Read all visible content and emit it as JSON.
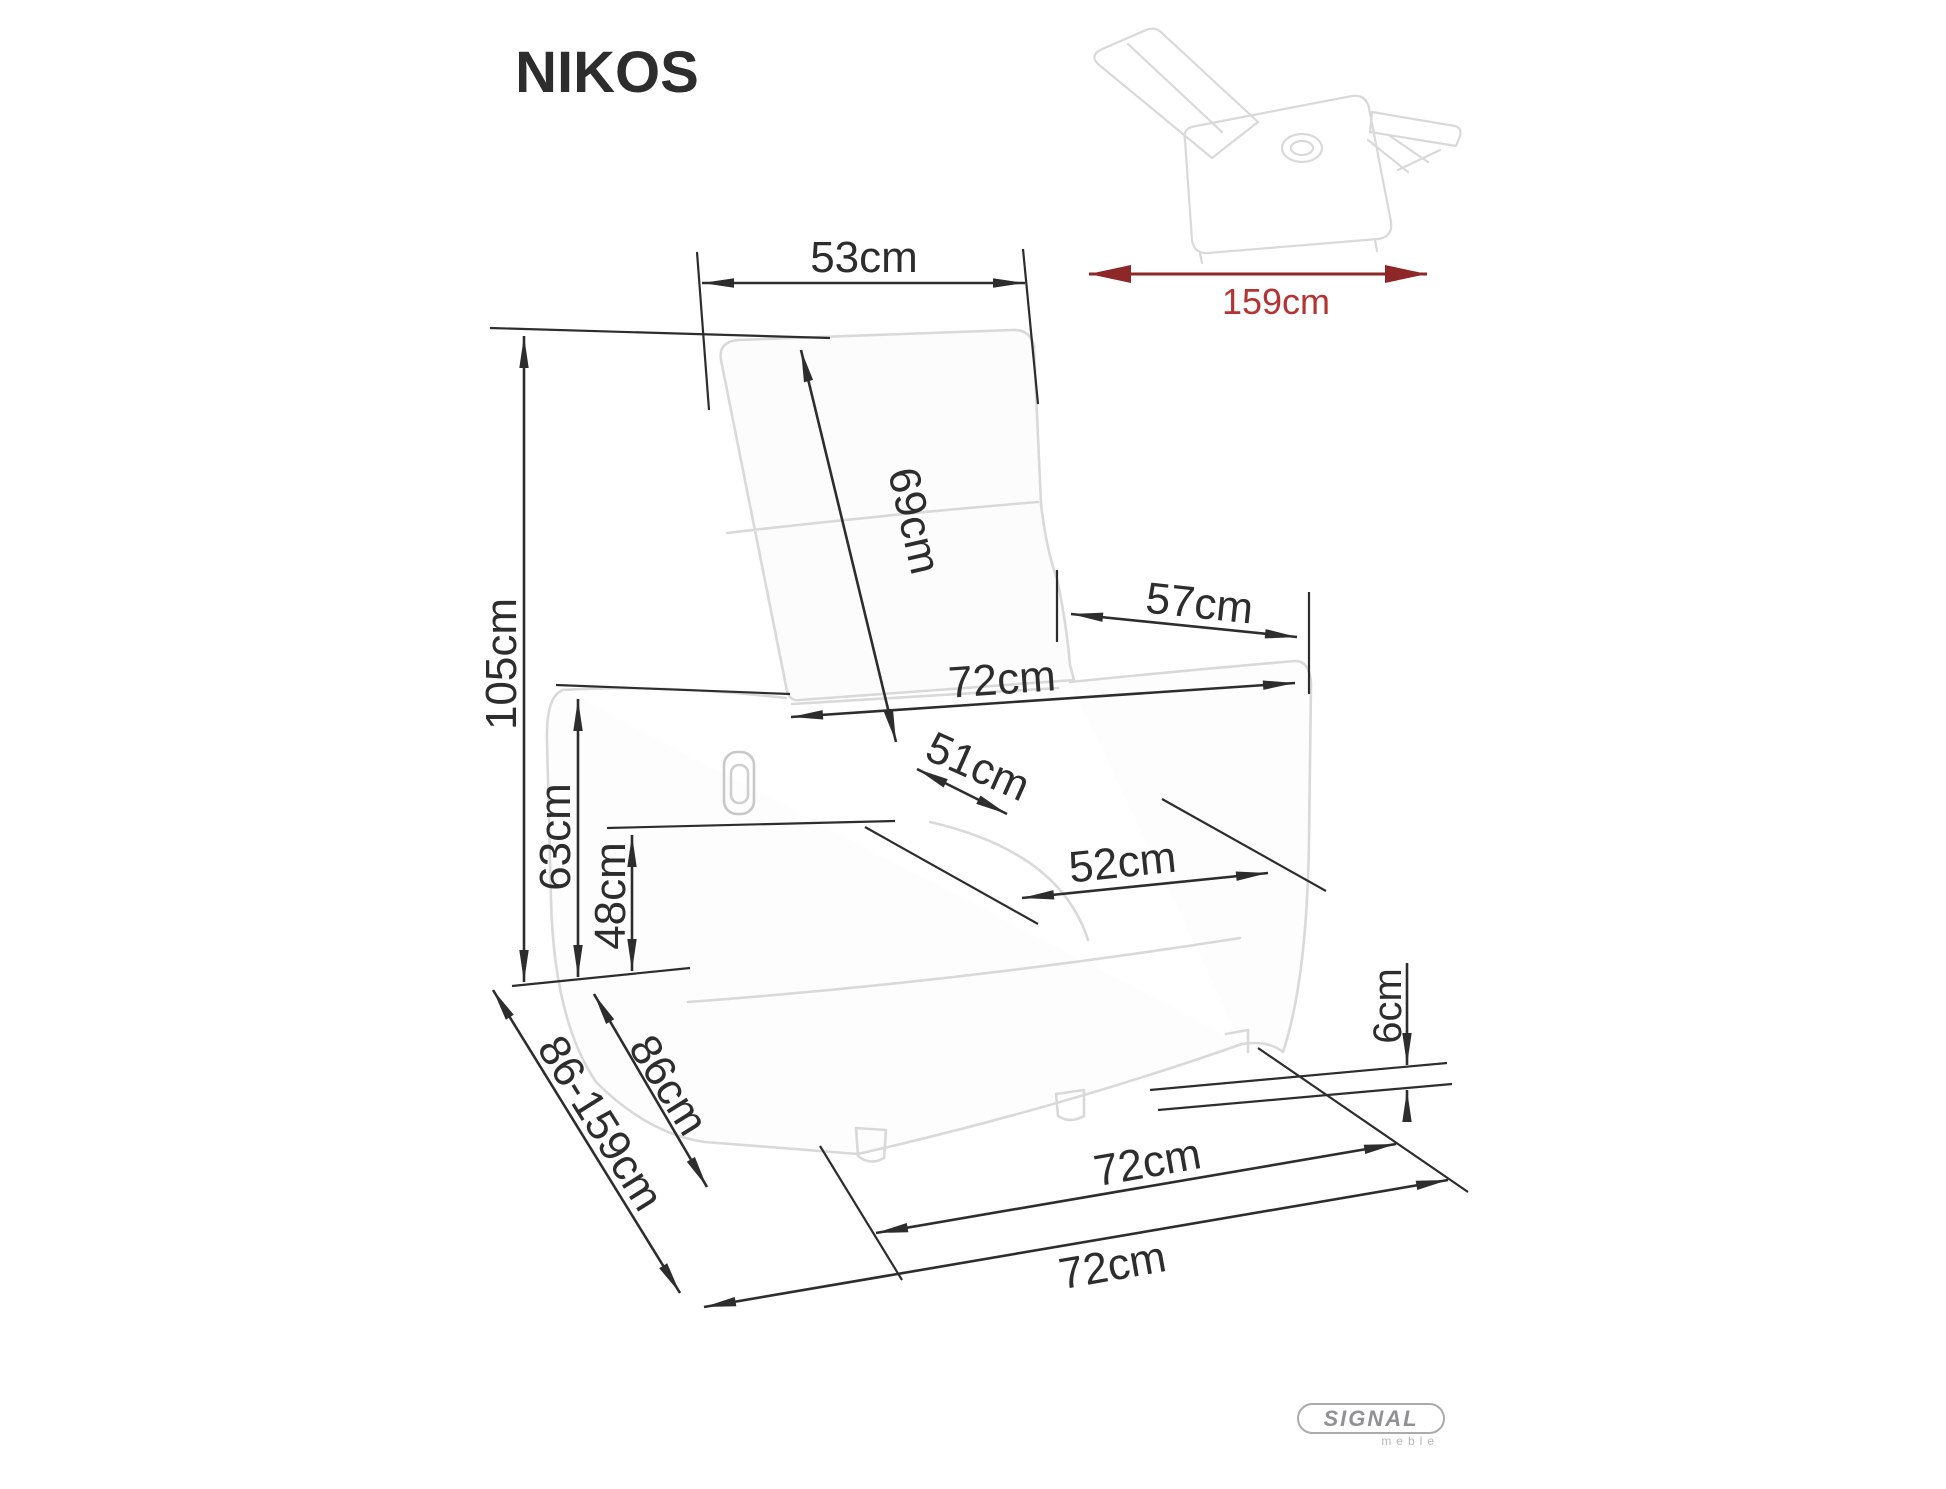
{
  "title": "NIKOS",
  "dims": {
    "top_width": "53cm",
    "backrest_len": "69cm",
    "upper_width": "57cm",
    "arm_width": "72cm",
    "seat_depth": "51cm",
    "seat_width": "52cm",
    "height": "105cm",
    "arm_height": "63cm",
    "seat_height": "48cm",
    "ground_clearance": "6cm",
    "depth": "86cm",
    "depth_range": "86-159cm",
    "base_width": "72cm",
    "overall_width": "72cm"
  },
  "inset": {
    "overall_length": "159cm"
  },
  "logo": {
    "brand": "SIGNAL",
    "sub": "meble"
  },
  "colors": {
    "dimension": "#2d2d2d",
    "chair_outline": "#d9d9d9",
    "chair_fill": "#fcfcfc",
    "red_line": "#8e2727",
    "red_text": "#b43333",
    "logo_gray": "#8f9193"
  }
}
